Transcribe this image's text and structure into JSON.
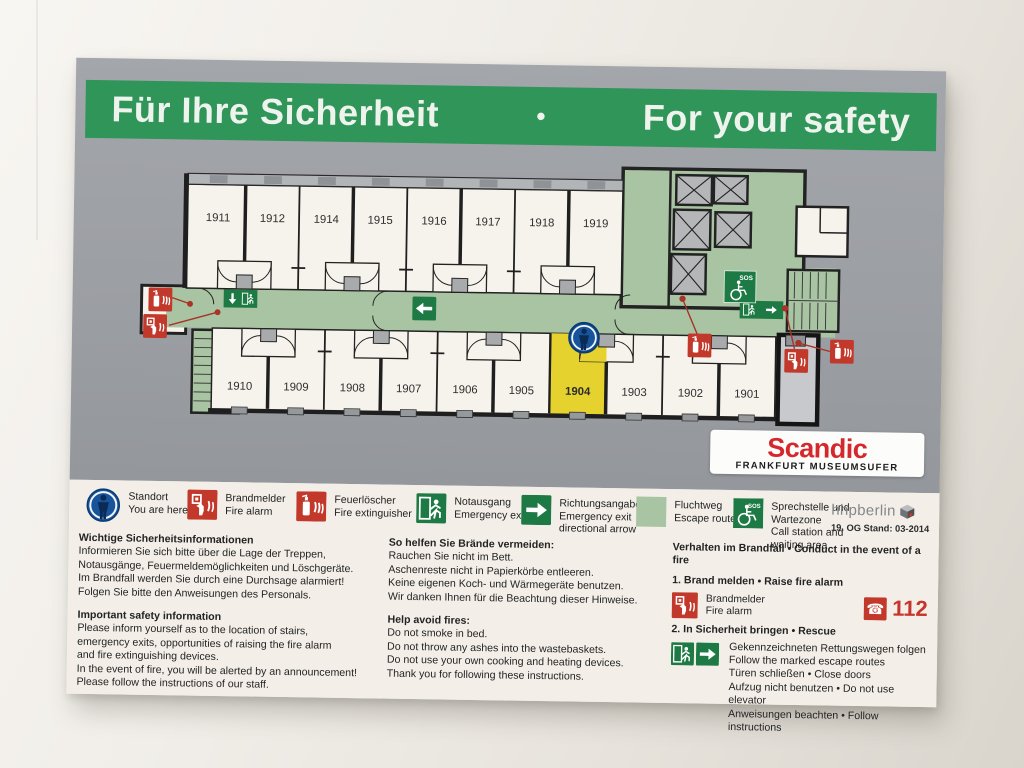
{
  "title": {
    "de": "Für Ihre Sicherheit",
    "separator": "•",
    "en": "For your safety"
  },
  "floor_plan": {
    "top_rooms": [
      "1911",
      "1912",
      "1914",
      "1915",
      "1916",
      "1917",
      "1918",
      "1919"
    ],
    "bottom_rooms": [
      "1910",
      "1909",
      "1908",
      "1907",
      "1906",
      "1905",
      "1904",
      "1903",
      "1902",
      "1901"
    ],
    "highlighted_room": "1904",
    "sos_label": "SOS"
  },
  "brand": {
    "name": "Scandic",
    "location": "FRANKFURT MUSEUMSUFER",
    "accent_color": "#d5282d"
  },
  "colors": {
    "header_green": "#2f9558",
    "escape_route_green": "#a9c4a2",
    "sign_green": "#1e7a44",
    "alarm_red": "#c2392b",
    "highlight_yellow": "#e6d22f",
    "marker_blue": "#17549c",
    "panel_gray": "#9b9ea3"
  },
  "legend": [
    {
      "icon": "you-are-here",
      "de": "Standort",
      "en": "You are here"
    },
    {
      "icon": "fire-alarm",
      "de": "Brandmelder",
      "en": "Fire alarm"
    },
    {
      "icon": "fire-extinguisher",
      "de": "Feuerlöscher",
      "en": "Fire extinguisher"
    },
    {
      "icon": "emergency-exit",
      "de": "Notausgang",
      "en": "Emergency exit"
    },
    {
      "icon": "direction-arrow",
      "de": "Richtungsangabe",
      "en": "Emergency exit directional arrow"
    },
    {
      "icon": "escape-route",
      "de": "Fluchtweg",
      "en": "Escape route"
    },
    {
      "icon": "call-station",
      "de": "Sprechstelle und Wartezone",
      "en": "Call station and waiting area"
    }
  ],
  "publisher": {
    "name": "hhpberlin",
    "floor_status": "19. OG Stand: 03-2014"
  },
  "info": {
    "safety_info": {
      "heading_de": "Wichtige Sicherheitsinformationen",
      "body_de": [
        "Informieren Sie sich bitte über die Lage der Treppen,",
        "Notausgänge, Feuermeldemöglichkeiten und Löschgeräte.",
        "Im Brandfall werden Sie durch eine Durchsage alarmiert!",
        "Folgen Sie bitte den Anweisungen des Personals."
      ],
      "heading_en": "Important safety information",
      "body_en": [
        "Please inform yourself as to the location of stairs,",
        "emergency exits, opportunities of raising the fire alarm",
        "and fire extinguishing devices.",
        "In the event of fire, you will be alerted by an announcement!",
        "Please follow the instructions of our staff."
      ]
    },
    "avoid_fires": {
      "heading_de": "So helfen Sie Brände vermeiden:",
      "body_de": [
        "Rauchen Sie nicht im Bett.",
        "Aschenreste nicht in Papierkörbe entleeren.",
        "Keine eigenen Koch- und Wärmegeräte benutzen.",
        "Wir danken Ihnen für die Beachtung dieser Hinweise."
      ],
      "heading_en": "Help avoid fires:",
      "body_en": [
        "Do not smoke in bed.",
        "Do not throw any ashes into the wastebaskets.",
        "Do not use your own cooking and heating devices.",
        "Thank you for following these instructions."
      ]
    },
    "conduct": {
      "heading": "Verhalten im Brandfall • Conduct in the event of a fire",
      "step1": "1. Brand melden • Raise fire alarm",
      "alarm_label_de": "Brandmelder",
      "alarm_label_en": "Fire alarm",
      "emergency_number": "112",
      "step2": "2. In Sicherheit bringen • Rescue",
      "rescue_lines": [
        "Gekennzeichneten Rettungswegen folgen",
        "Follow the marked escape routes",
        "Türen schließen • Close doors",
        "Aufzug nicht benutzen • Do not use elevator",
        "Anweisungen beachten • Follow instructions"
      ]
    }
  }
}
